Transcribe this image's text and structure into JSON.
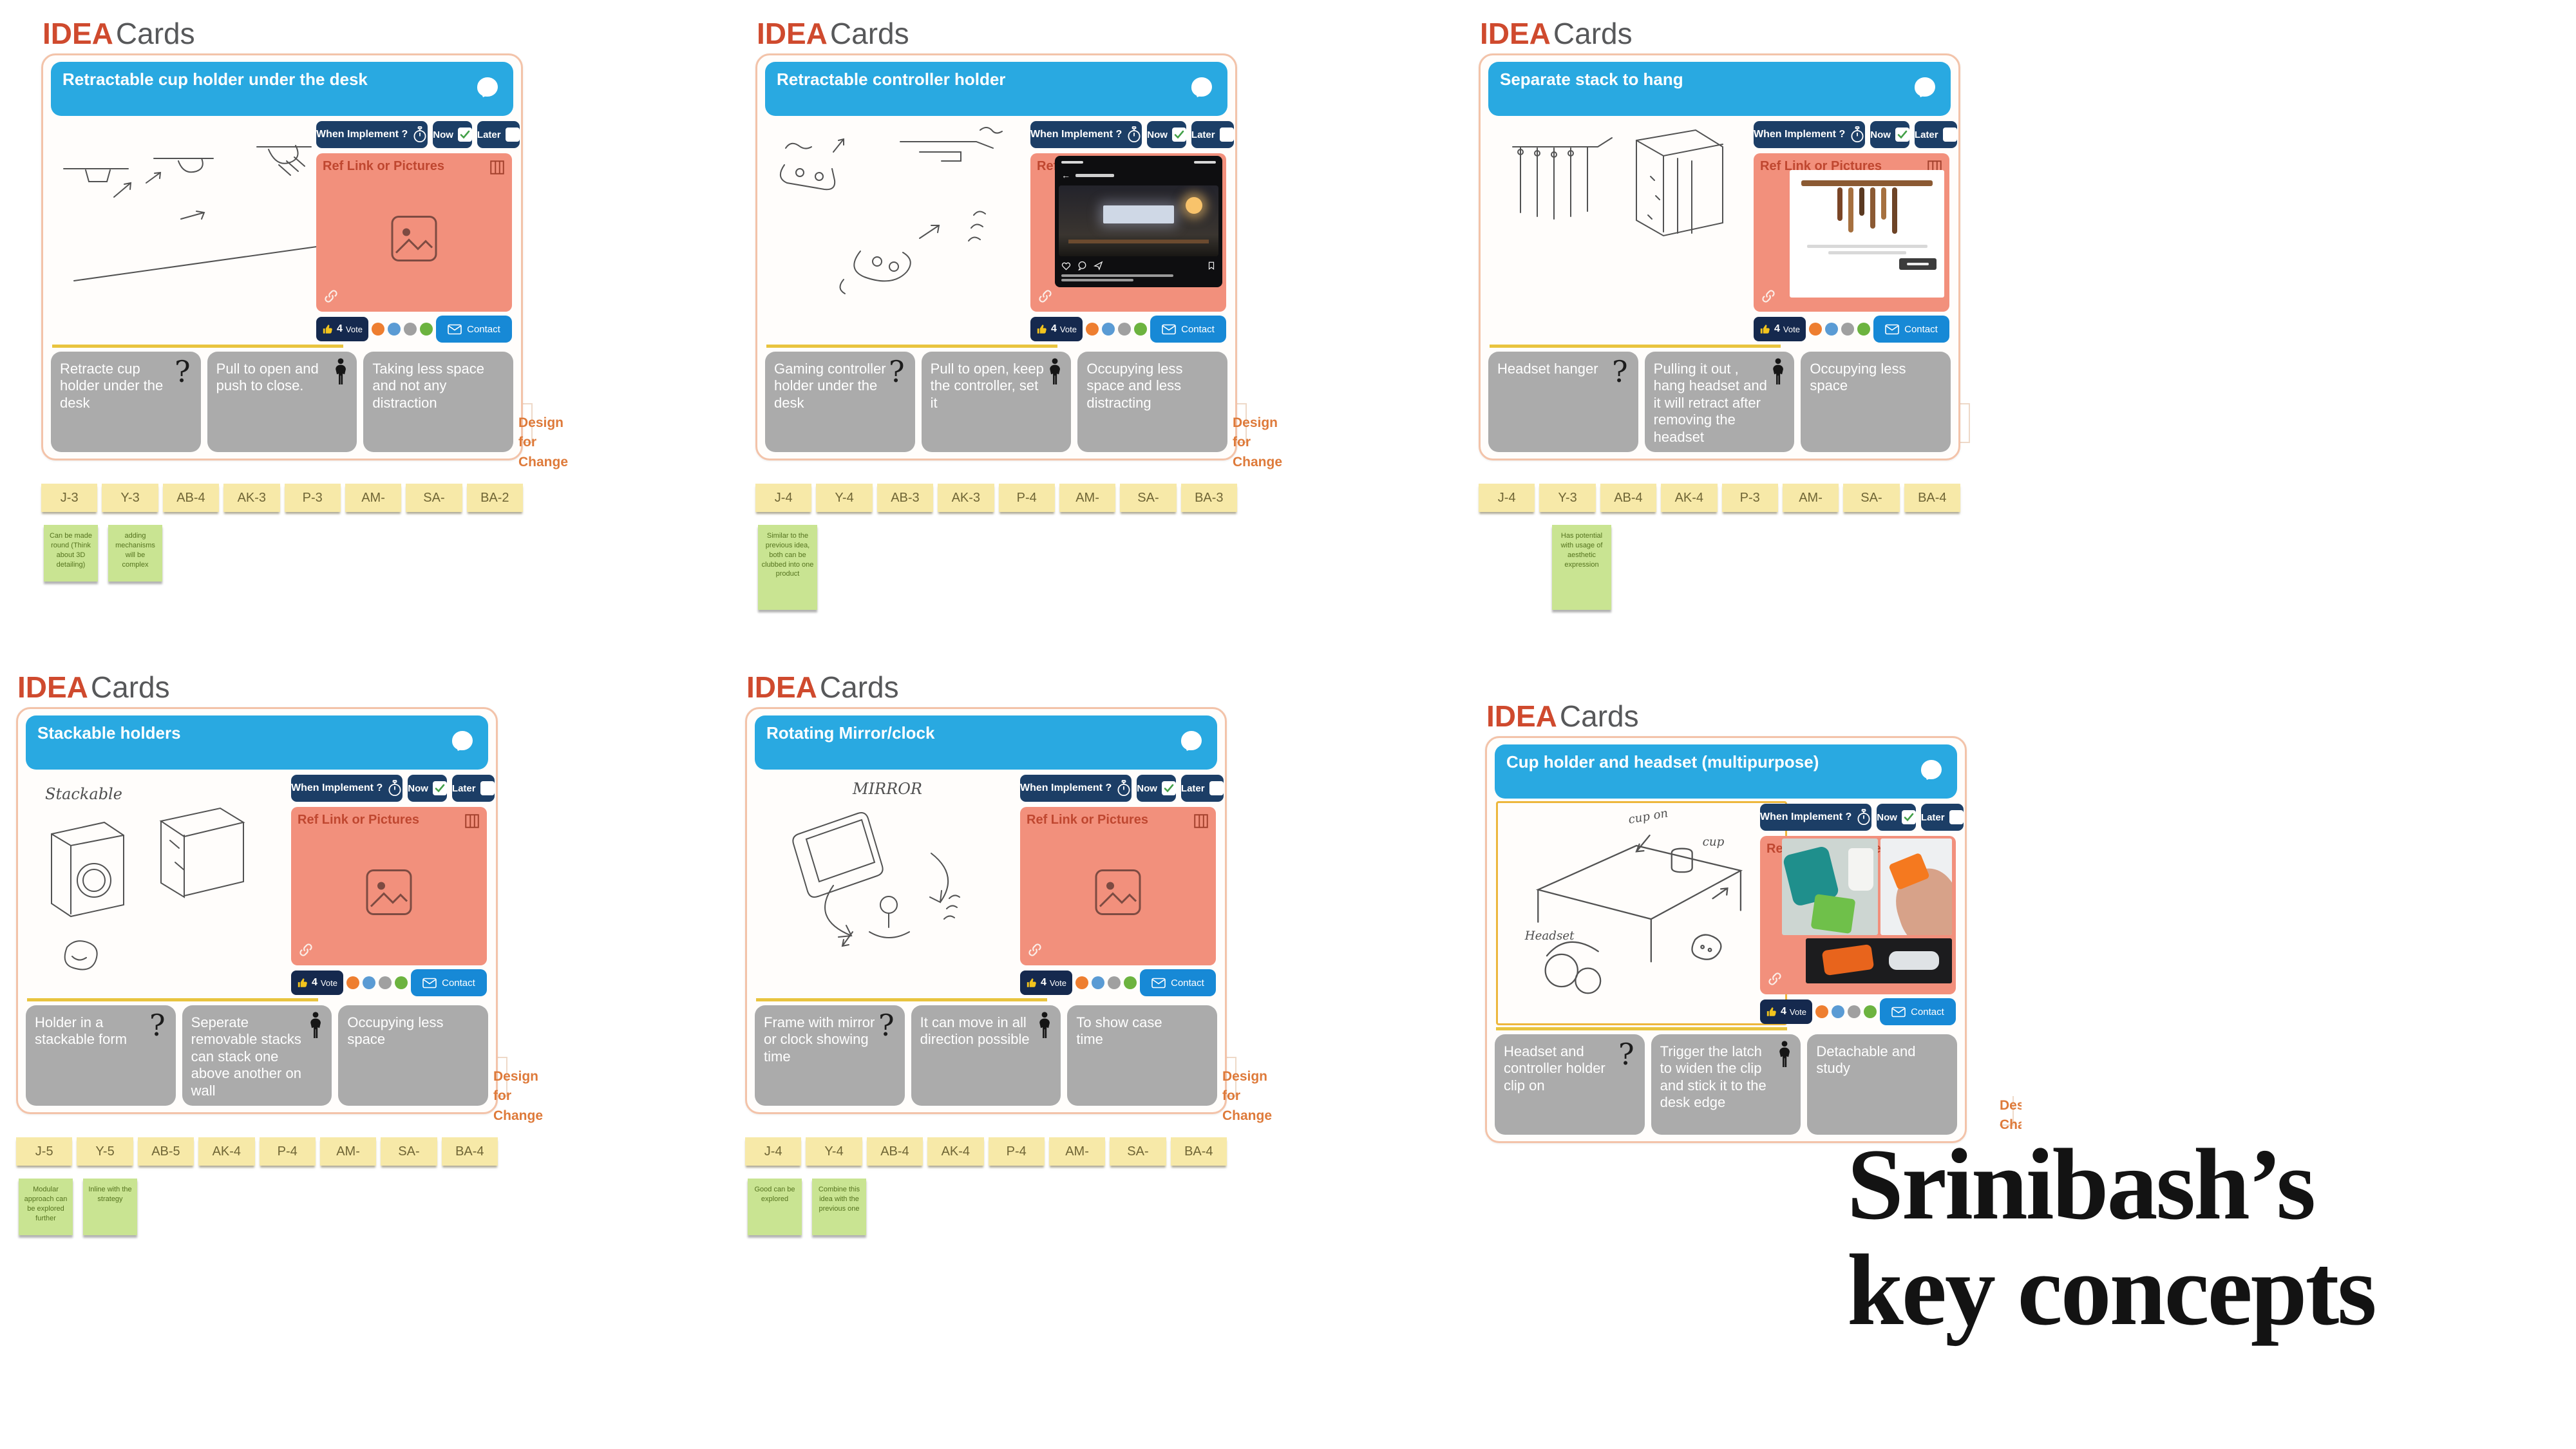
{
  "labels": {
    "idea": "IDEA",
    "cards": "Cards",
    "when_implement": "When Implement ?",
    "now": "Now",
    "later": "Later",
    "ref_title": "Ref Link or Pictures",
    "vote": "Vote",
    "contact": "Contact",
    "design_for_change_line1": "Design for",
    "design_for_change_line2": "Change"
  },
  "big_title": {
    "line1": "Srinibash’s",
    "line2": "key concepts"
  },
  "colors": {
    "title_bar_blue": "#29A9E1",
    "ref_salmon": "#F2907C",
    "navy": "#1C3E66",
    "contact_blue": "#1789D6",
    "idea_red": "#CF4A2E",
    "tag_yellow": "#F7E9A8",
    "sticky_green": "#C9E492",
    "gray_box": "#ABABAB",
    "design_change_orange": "#DE7A3A",
    "dot_orange": "#EE7E30",
    "dot_blue": "#5A9BD4",
    "dot_gray": "#A0A0A0",
    "dot_green": "#6CB33F"
  },
  "cards": [
    {
      "title": "Retractable  cup holder under the desk",
      "vote_count": "4",
      "now_checked": true,
      "boxes": [
        "Retracte  cup holder under  the  desk",
        "Pull to open  and push  to close.",
        "Taking  less  space and  not  any distraction"
      ],
      "tags": [
        "J-3",
        "Y-3",
        "AB-4",
        "AK-3",
        "P-3",
        "AM-",
        "SA-",
        "BA-2"
      ],
      "stickies": [
        "Can be made round (Think about 3D detailing)",
        "adding mechanisms will be complex"
      ],
      "sketch_labels": []
    },
    {
      "title": "Retractable  controller  holder",
      "vote_count": "4",
      "now_checked": true,
      "boxes": [
        "Gaming  controller holder  under  the desk",
        "Pull to open, keep the  controller, set it",
        "Occupying  less space  and  less distracting"
      ],
      "tags": [
        "J-4",
        "Y-4",
        "AB-3",
        "AK-3",
        "P-4",
        "AM-",
        "SA-",
        "BA-3"
      ],
      "stickies": [
        "Similar to the previous idea, both can be clubbed into one product"
      ],
      "sketch_labels": []
    },
    {
      "title": "Separate  stack  to  hang",
      "vote_count": "4",
      "now_checked": true,
      "boxes": [
        "Headset  hanger",
        "Pulling  it  out , hang headset  and  it  will retract  after  removing the  headset",
        "Occupying  less space"
      ],
      "tags": [
        "J-4",
        "Y-3",
        "AB-4",
        "AK-4",
        "P-3",
        "AM-",
        "SA-",
        "BA-4"
      ],
      "stickies": [
        "Has potential with usage of aesthetic expression"
      ],
      "sketch_labels": []
    },
    {
      "title": "Stackable  holders",
      "vote_count": "4",
      "now_checked": true,
      "boxes": [
        "Holder  in  a stackable  form",
        "Seperate removable stacks  can  stack one  above another  on  wall",
        "Occupying  less  space"
      ],
      "tags": [
        "J-5",
        "Y-5",
        "AB-5",
        "AK-4",
        "P-4",
        "AM-",
        "SA-",
        "BA-4"
      ],
      "stickies": [
        "Modular approach can be explored further",
        "Inline with the strategy"
      ],
      "sketch_labels": [
        "Stackable"
      ]
    },
    {
      "title": "Rotating  Mirror/clock",
      "vote_count": "4",
      "now_checked": true,
      "boxes": [
        "Frame  with  mirror or  clock  showing time",
        "It  can  move  in  all direction  possible",
        "To  show  case time"
      ],
      "tags": [
        "J-4",
        "Y-4",
        "AB-4",
        "AK-4",
        "P-4",
        "AM-",
        "SA-",
        "BA-4"
      ],
      "stickies": [
        "Good can be explored",
        "Combine this idea with the previous one"
      ],
      "sketch_labels": [
        "MIRROR"
      ]
    },
    {
      "title": "Cup holder and headset  (multipurpose)",
      "vote_count": "4",
      "now_checked": true,
      "boxes": [
        "Headset  and controller  holder clip  on",
        "Trigger  the  latch  to widen  the  clip  and stick  it  to  the  desk edge",
        "Detachable  and study"
      ],
      "tags": [],
      "stickies": [],
      "sketch_labels": [
        "cup on",
        "Headset",
        "cup"
      ]
    }
  ]
}
